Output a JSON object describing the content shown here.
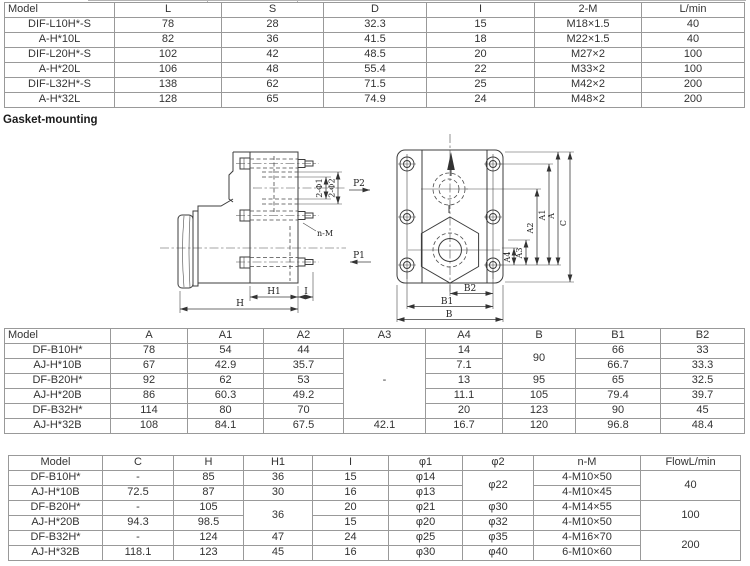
{
  "page": {
    "heading_gasket": "Gasket-mounting"
  },
  "colors": {
    "table_border": "#999999",
    "table_text": "#333333",
    "drawing_line": "#3c3c3c",
    "background": "#ffffff"
  },
  "table1": {
    "headers": [
      "Model",
      "L",
      "S",
      "D",
      "I",
      "2-M",
      "L/min"
    ],
    "col_widths": [
      110,
      107,
      102,
      103,
      108,
      107,
      103
    ],
    "rows": [
      [
        "DIF-L10H*-S",
        "78",
        "28",
        "32.3",
        "15",
        "M18×1.5",
        "40"
      ],
      [
        "A-H*10L",
        "82",
        "36",
        "41.5",
        "18",
        "M22×1.5",
        "40"
      ],
      [
        "DIF-L20H*-S",
        "102",
        "42",
        "48.5",
        "20",
        "M27×2",
        "100"
      ],
      [
        "A-H*20L",
        "106",
        "48",
        "55.4",
        "22",
        "M33×2",
        "100"
      ],
      [
        "DIF-L32H*-S",
        "138",
        "62",
        "71.5",
        "25",
        "M42×2",
        "200"
      ],
      [
        "A-H*32L",
        "128",
        "65",
        "74.9",
        "24",
        "M48×2",
        "200"
      ]
    ]
  },
  "table2": {
    "headers": [
      "Model",
      "A",
      "A1",
      "A2",
      "A3",
      "A4",
      "B",
      "B1",
      "B2"
    ],
    "col_widths": [
      106,
      77,
      76,
      80,
      82,
      77,
      73,
      85,
      84
    ],
    "rows": [
      [
        "DF-B10H*",
        "78",
        "54",
        "44",
        {
          "t": "-",
          "rs": 5
        },
        "14",
        {
          "t": "90",
          "rs": 2
        },
        "66",
        "33"
      ],
      [
        "AJ-H*10B",
        "67",
        "42.9",
        "35.7",
        null,
        "7.1",
        null,
        "66.7",
        "33.3"
      ],
      [
        "DF-B20H*",
        "92",
        "62",
        "53",
        null,
        "13",
        "95",
        "65",
        "32.5"
      ],
      [
        "AJ-H*20B",
        "86",
        "60.3",
        "49.2",
        null,
        "11.1",
        "105",
        "79.4",
        "39.7"
      ],
      [
        "DF-B32H*",
        "114",
        "80",
        "70",
        null,
        "20",
        "123",
        "90",
        "45"
      ],
      [
        "AJ-H*32B",
        "108",
        "84.1",
        "67.5",
        "42.1",
        "16.7",
        "120",
        "96.8",
        "48.4"
      ]
    ]
  },
  "table3": {
    "headers": [
      "Model",
      "C",
      "H",
      "H1",
      "I",
      "φ1",
      "φ2",
      "n-M",
      "FlowL/min"
    ],
    "col_widths": [
      94,
      71,
      70,
      69,
      76,
      74,
      71,
      107,
      100
    ],
    "rows": [
      [
        "DF-B10H*",
        "-",
        "85",
        "36",
        "15",
        "φ14",
        {
          "t": "φ22",
          "rs": 2
        },
        "4-M10×50",
        {
          "t": "40",
          "rs": 2
        }
      ],
      [
        "AJ-H*10B",
        "72.5",
        "87",
        "30",
        "16",
        "φ13",
        null,
        "4-M10×45",
        null
      ],
      [
        "DF-B20H*",
        "-",
        "105",
        {
          "t": "36",
          "rs": 2
        },
        "20",
        "φ21",
        "φ30",
        "4-M14×55",
        {
          "t": "100",
          "rs": 2
        }
      ],
      [
        "AJ-H*20B",
        "94.3",
        "98.5",
        null,
        "15",
        "φ20",
        "φ32",
        "4-M10×50",
        null
      ],
      [
        "DF-B32H*",
        "-",
        "124",
        "47",
        "24",
        "φ25",
        "φ35",
        "4-M16×70",
        {
          "t": "200",
          "rs": 2
        }
      ],
      [
        "AJ-H*32B",
        "118.1",
        "123",
        "45",
        "16",
        "φ30",
        "φ40",
        "6-M10×60",
        null
      ]
    ]
  },
  "drawing": {
    "labels": {
      "p2": "P2",
      "p1": "P1",
      "n_m": "n-M",
      "two_phi1": "2-Φ1",
      "two_phi2": "2-Φ2",
      "h": "H",
      "h1": "H1",
      "i": "I",
      "b": "B",
      "b1": "B1",
      "b2": "B2",
      "a": "A",
      "a1": "A1",
      "a2": "A2",
      "a3": "A3",
      "a4": "A4",
      "c": "C"
    }
  }
}
